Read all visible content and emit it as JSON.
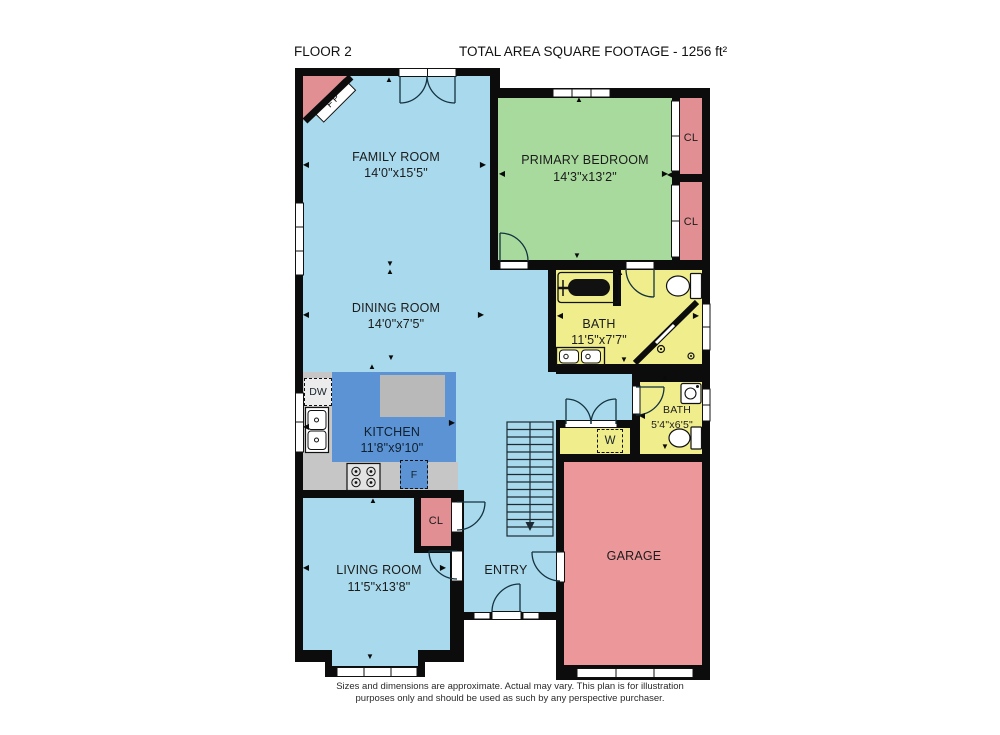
{
  "header": {
    "floor_label": "FLOOR 2",
    "area_label": "TOTAL AREA SQUARE FOOTAGE - 1256 ft²"
  },
  "rooms": {
    "family": {
      "name": "FAMILY ROOM",
      "dims": "14'0\"x15'5\""
    },
    "bedroom": {
      "name": "PRIMARY BEDROOM",
      "dims": "14'3\"x13'2\""
    },
    "dining": {
      "name": "DINING ROOM",
      "dims": "14'0\"x7'5\""
    },
    "kitchen": {
      "name": "KITCHEN",
      "dims": "11'8\"x9'10\""
    },
    "bath_main": {
      "name": "BATH",
      "dims": "11'5\"x7'7\""
    },
    "bath_small": {
      "name": "BATH",
      "dims": "5'4\"x6'5\""
    },
    "living": {
      "name": "LIVING ROOM",
      "dims": "11'5\"x13'8\""
    },
    "entry": {
      "name": "ENTRY"
    },
    "garage": {
      "name": "GARAGE"
    },
    "closet_top": {
      "name": "CL"
    },
    "closet_bottom": {
      "name": "CL"
    },
    "closet_entry": {
      "name": "CL"
    }
  },
  "fixtures": {
    "fireplace": "FP",
    "dishwasher": "DW",
    "fridge": "F",
    "washer": "W"
  },
  "disclaimer": {
    "line1": "Sizes and dimensions are approximate. Actual may vary. This plan is for illustration",
    "line2": "purposes only and should be used as such by any perspective purchaser."
  },
  "colors": {
    "floor_blue": "#a9d9ec",
    "kitchen_blue": "#5b93d5",
    "bedroom_green": "#a8da9e",
    "bath_yellow": "#f0ee8c",
    "closet_pink": "#e28f94",
    "garage_pink": "#ec989b",
    "counter_gray": "#c6c6c6",
    "wall_black": "#0c0c0c"
  }
}
